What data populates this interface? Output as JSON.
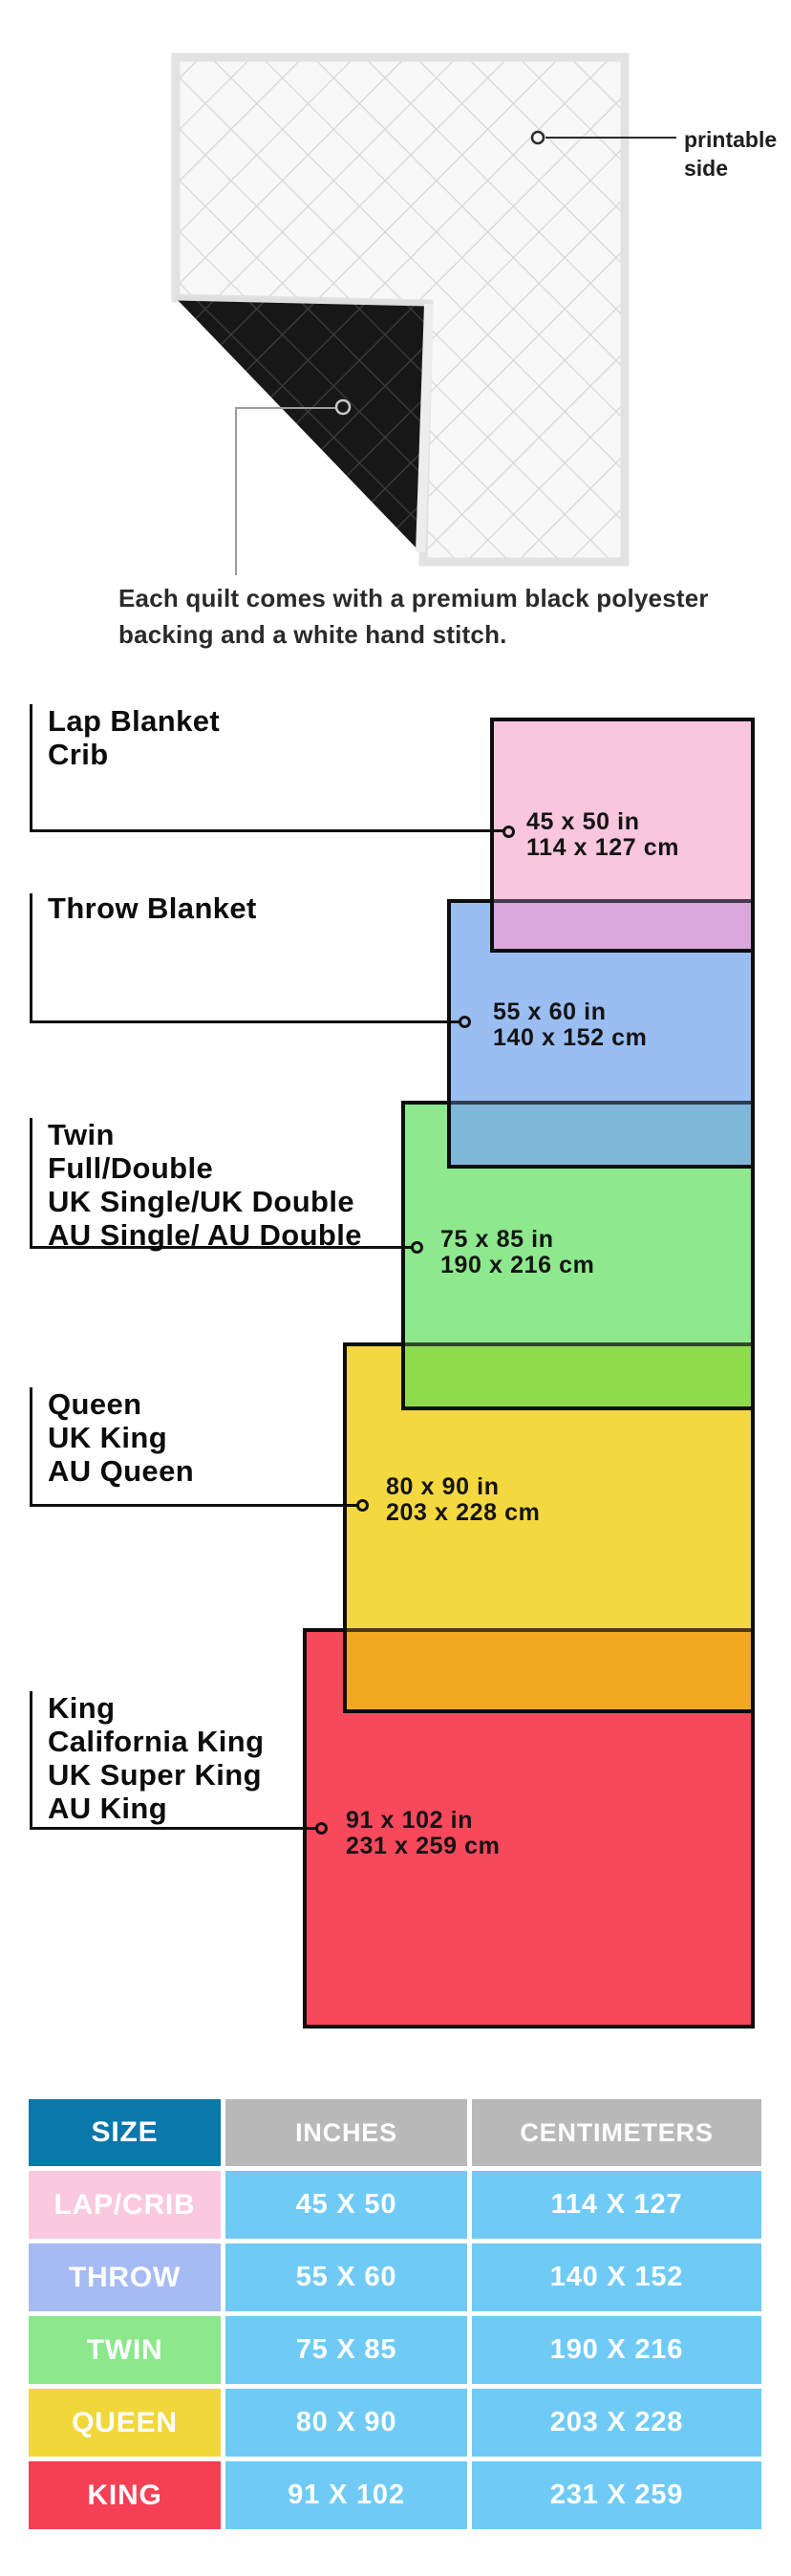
{
  "quilt": {
    "printable_line1": "printable",
    "printable_line2": "side",
    "caption_line1": "Each quilt comes with a premium black polyester",
    "caption_line2": "backing and a white hand stitch."
  },
  "diagram": {
    "items": [
      {
        "id": "lap",
        "label_lines": [
          "Lap Blanket",
          "Crib"
        ],
        "dims": [
          "45 x 50 in",
          "114 x 127 cm"
        ],
        "fill": "#f9c6de",
        "overlap_fill": "#d8a8dc"
      },
      {
        "id": "throw",
        "label_lines": [
          "Throw Blanket"
        ],
        "dims": [
          "55 x 60 in",
          "140 x 152 cm"
        ],
        "fill": "#9abdf2",
        "overlap_fill": "#7fb7d8"
      },
      {
        "id": "twin",
        "label_lines": [
          "Twin",
          "Full/Double",
          "UK Single/UK Double",
          "AU Single/ AU Double"
        ],
        "dims": [
          "75 x 85 in",
          "190 x 216 cm"
        ],
        "fill": "#8ee88e",
        "overlap_fill": "#8edc4b"
      },
      {
        "id": "queen",
        "label_lines": [
          "Queen",
          "UK King",
          "AU Queen"
        ],
        "dims": [
          "80 x 90 in",
          "203 x 228 cm"
        ],
        "fill": "#f4d840",
        "overlap_fill": "#f3a91f"
      },
      {
        "id": "king",
        "label_lines": [
          "King",
          "California King",
          "UK Super King",
          "AU King"
        ],
        "dims": [
          "91 x 102 in",
          "231 x 259 cm"
        ],
        "fill": "#f7485c"
      }
    ]
  },
  "table": {
    "headers": [
      "SIZE",
      "INCHES",
      "CENTIMETERS"
    ],
    "header_colors": {
      "size": "#0a78aa",
      "measure": "#b9b9b9"
    },
    "data_cell_color": "#6fcbf5",
    "rows": [
      {
        "label": "LAP/CRIB",
        "inches": "45 X 50",
        "centimeters": "114 X 127",
        "color": "#fbc9df"
      },
      {
        "label": "THROW",
        "inches": "55 X 60",
        "centimeters": "140 X 152",
        "color": "#a6bbf4"
      },
      {
        "label": "TWIN",
        "inches": "75 X 85",
        "centimeters": "190 X 216",
        "color": "#8be88c"
      },
      {
        "label": "QUEEN",
        "inches": "80 X 90",
        "centimeters": "203 X 228",
        "color": "#f2d73b"
      },
      {
        "label": "KING",
        "inches": "91 X 102",
        "centimeters": "231 X 259",
        "color": "#f43f55"
      }
    ]
  }
}
